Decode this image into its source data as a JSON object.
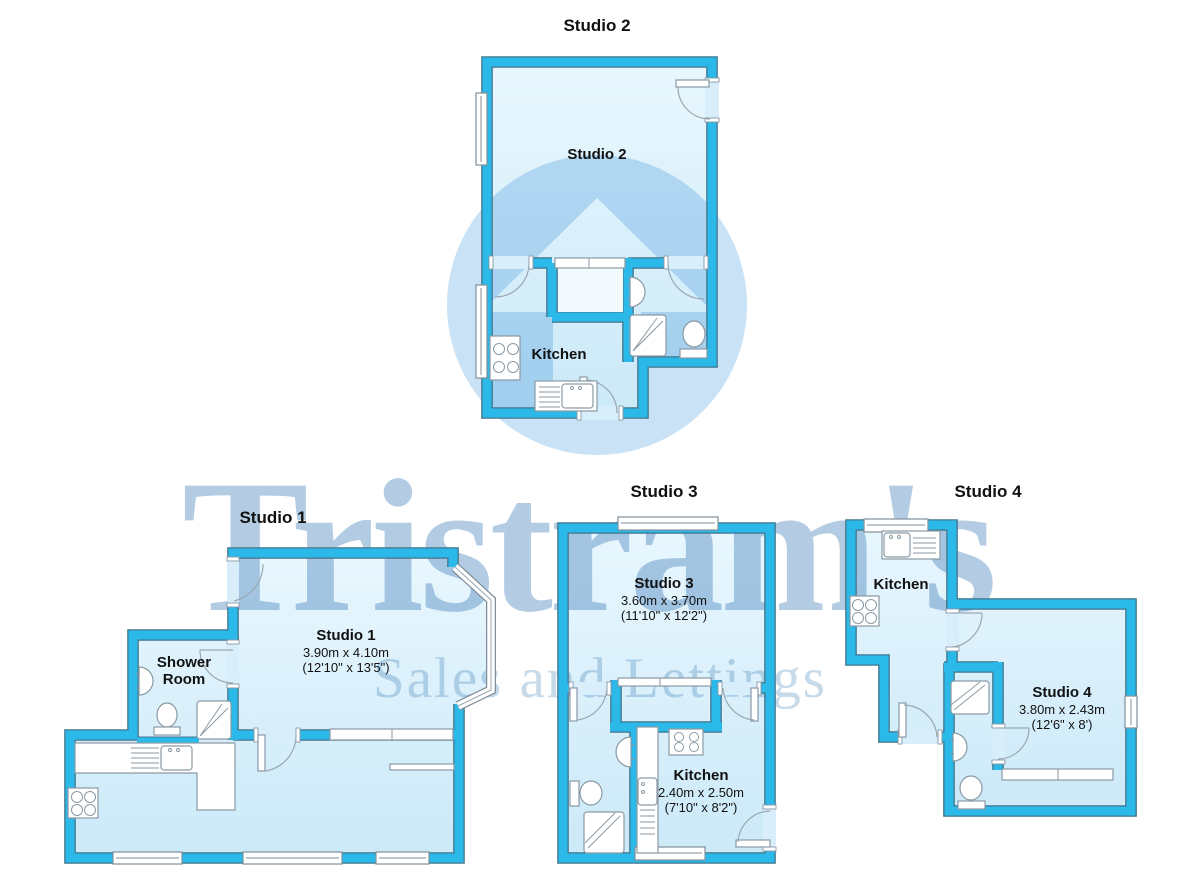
{
  "watermark": {
    "brand": "Tristram's",
    "tagline": "Sales and Lettings",
    "brand_color": "#b4cce3",
    "tagline_color": "#c6daea",
    "logo_circle_color": "#c9e2f5"
  },
  "colors": {
    "wall_fill": "#2ab9e9",
    "wall_outline": "#41758d",
    "room_fill_top": "#e9f7fe",
    "room_fill_bottom": "#cbe9f8"
  },
  "plans": {
    "studio1": {
      "title": "Studio 1",
      "room": {
        "name": "Studio 1",
        "dims_metric": "3.90m x 4.10m",
        "dims_imperial": "(12'10\" x 13'5\")"
      },
      "shower_room": {
        "line1": "Shower",
        "line2": "Room"
      }
    },
    "studio2": {
      "title": "Studio 2",
      "room": {
        "name": "Studio 2"
      },
      "kitchen": {
        "name": "Kitchen"
      }
    },
    "studio3": {
      "title": "Studio 3",
      "room": {
        "name": "Studio 3",
        "dims_metric": "3.60m x 3.70m",
        "dims_imperial": "(11'10\" x 12'2\")"
      },
      "kitchen": {
        "name": "Kitchen",
        "dims_metric": "2.40m x 2.50m",
        "dims_imperial": "(7'10\" x 8'2\")"
      }
    },
    "studio4": {
      "title": "Studio 4",
      "room": {
        "name": "Studio 4",
        "dims_metric": "3.80m x 2.43m",
        "dims_imperial": "(12'6\" x 8')"
      },
      "kitchen": {
        "name": "Kitchen"
      }
    }
  }
}
